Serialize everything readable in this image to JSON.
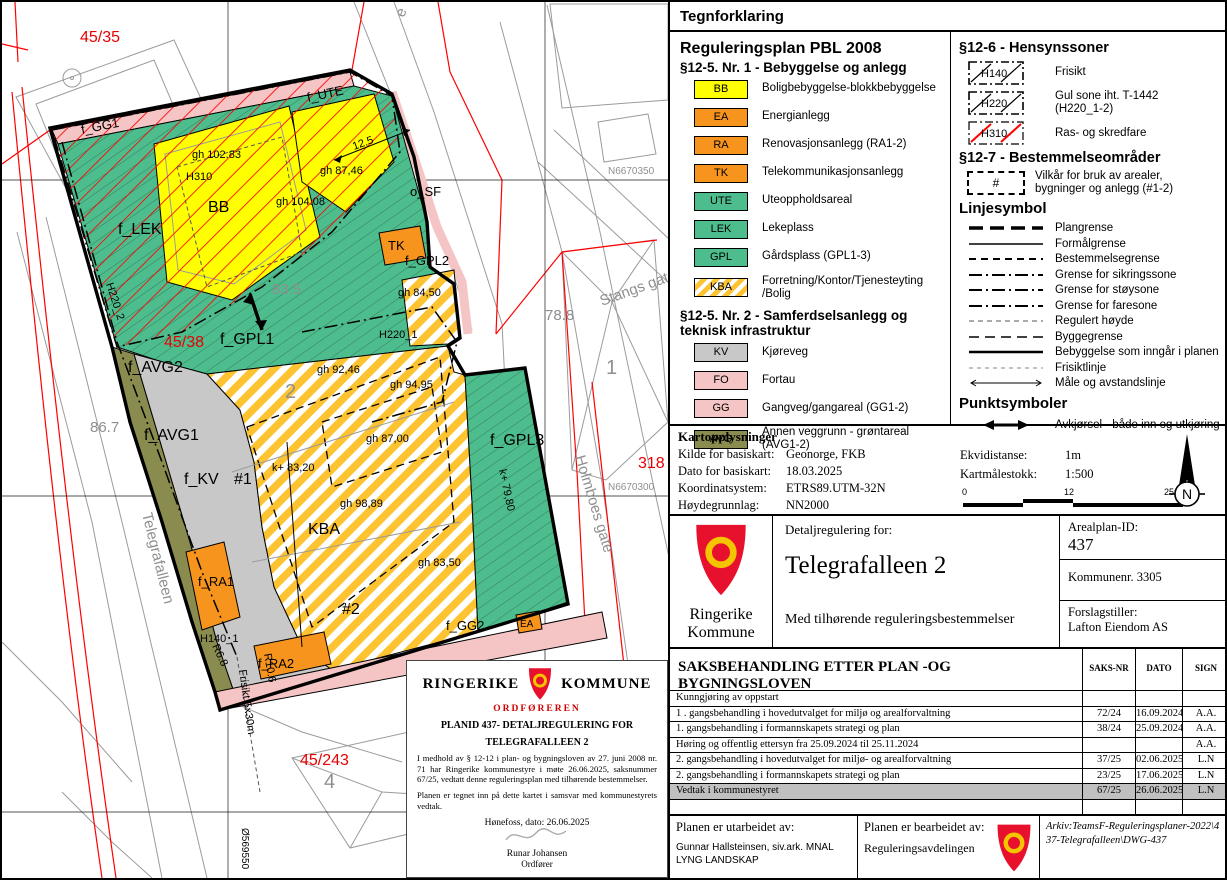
{
  "legend": {
    "title": "Tegnforklaring",
    "plan_heading": "Reguleringsplan PBL 2008",
    "s125_nr1_heading": "§12-5. Nr. 1 - Bebyggelse og anlegg",
    "s125_nr1_items": [
      {
        "code": "BB",
        "label": "Boligbebyggelse-blokkbebyggelse"
      },
      {
        "code": "EA",
        "label": "Energianlegg"
      },
      {
        "code": "RA",
        "label": "Renovasjonsanlegg (RA1-2)"
      },
      {
        "code": "TK",
        "label": "Telekommunikasjonsanlegg"
      },
      {
        "code": "UTE",
        "label": "Uteoppholdsareal"
      },
      {
        "code": "LEK",
        "label": "Lekeplass"
      },
      {
        "code": "GPL",
        "label": "Gårdsplass (GPL1-3)"
      },
      {
        "code": "KBA",
        "label": "Forretning/Kontor/Tjenesteyting /Bolig"
      }
    ],
    "s125_nr2_heading": "§12-5. Nr. 2 - Samferdselsanlegg og teknisk infrastruktur",
    "s125_nr2_items": [
      {
        "code": "KV",
        "label": "Kjøreveg"
      },
      {
        "code": "FO",
        "label": "Fortau"
      },
      {
        "code": "GG",
        "label": "Gangveg/gangareal (GG1-2)"
      },
      {
        "code": "AVG",
        "label": "Annen veggrunn - grøntareal (AVG1-2)"
      }
    ],
    "s126_heading": "§12-6 - Hensynssoner",
    "s126_items": [
      {
        "code": "H140",
        "label": "Frisikt"
      },
      {
        "code": "H220",
        "label": "Gul sone iht. T-1442 (H220_1-2)"
      },
      {
        "code": "H310",
        "label": "Ras- og skredfare"
      }
    ],
    "s127_heading": "§12-7 - Bestemmelseområder",
    "s127_code": "#",
    "s127_label": "Vilkår for bruk av arealer, bygninger og anlegg (#1-2)",
    "linjesymbol_heading": "Linjesymbol",
    "line_items": [
      {
        "label": "Plangrense",
        "style": "ls-plangrense"
      },
      {
        "label": "Formålgrense",
        "style": "ls-formal"
      },
      {
        "label": "Bestemmelsegrense",
        "style": "ls-bestemmelse"
      },
      {
        "label": "Grense for sikringssone",
        "style": "ls-sikring"
      },
      {
        "label": "Grense for støysone",
        "style": "ls-stoy"
      },
      {
        "label": "Grense for faresone",
        "style": "ls-fare"
      },
      {
        "label": "Regulert høyde",
        "style": "ls-hoyde"
      },
      {
        "label": "Byggegrense",
        "style": "ls-bygg"
      },
      {
        "label": "Bebyggelse som inngår i planen",
        "style": "ls-bebyggelse"
      },
      {
        "label": "Frisiktlinje",
        "style": "ls-frisikt"
      },
      {
        "label": "Måle og avstandslinje",
        "style": "ls-male"
      }
    ],
    "punktsymboler_heading": "Punktsymboler",
    "point_item_label": "Avkjørsel - både inn og utkjøring"
  },
  "map_info": {
    "heading": "Kartopplysninger",
    "rows": [
      {
        "label": "Kilde for basiskart:",
        "value": "Geonorge, FKB"
      },
      {
        "label": "Dato for basiskart:",
        "value": "18.03.2025"
      },
      {
        "label": "Koordinatsystem:",
        "value": "ETRS89.UTM-32N"
      },
      {
        "label": "Høydegrunnlag:",
        "value": "NN2000"
      }
    ],
    "rows_right": [
      {
        "label": "Ekvidistanse:",
        "value": "1m"
      },
      {
        "label": "Kartmålestokk:",
        "value": "1:500"
      }
    ],
    "scale_ticks": [
      "0",
      "12",
      "25m"
    ],
    "north_letter": "N"
  },
  "title_block": {
    "municipality_line1": "Ringerike",
    "municipality_line2": "Kommune",
    "detail_label": "Detaljregulering for:",
    "plan_name": "Telegrafalleen 2",
    "subtitle": "Med tilhørende reguleringsbestemmelser",
    "arealplan_label": "Arealplan-ID:",
    "arealplan_id": "437",
    "kommunenr": "Kommunenr. 3305",
    "forslagstiller_label": "Forslagstiller:",
    "forslagstiller": "Lafton Eiendom AS"
  },
  "case_table": {
    "title": "SAKSBEHANDLING ETTER PLAN -OG BYGNINGSLOVEN",
    "col_nr": "SAKS-NR",
    "col_dato": "DATO",
    "col_sign": "SIGN",
    "rows": [
      {
        "desc": "Kunngjøring av oppstart",
        "nr": "",
        "date": "",
        "sign": "",
        "hl": false
      },
      {
        "desc": "1 . gangsbehandling i hovedutvalget for miljø og arealforvaltning",
        "nr": "72/24",
        "date": "16.09.2024",
        "sign": "A.A.",
        "hl": false
      },
      {
        "desc": "1. gangsbehandling i formannskapets strategi og plan",
        "nr": "38/24",
        "date": "25.09.2024",
        "sign": "A.A.",
        "hl": false
      },
      {
        "desc": "Høring og offentlig ettersyn  fra 25.09.2024 til 25.11.2024",
        "nr": "",
        "date": "",
        "sign": "A.A.",
        "hl": false
      },
      {
        "desc": "2. gangsbehandling i hovedutvalget for miljø- og arealforvaltning",
        "nr": "37/25",
        "date": "02.06.2025",
        "sign": "L.N",
        "hl": false
      },
      {
        "desc": "2. gangsbehandling i formannskapets strategi og plan",
        "nr": "23/25",
        "date": "17.06.2025",
        "sign": "L.N",
        "hl": false
      },
      {
        "desc": "Vedtak i kommunestyret",
        "nr": "67/25",
        "date": "26.06.2025",
        "sign": "L.N",
        "hl": true
      },
      {
        "desc": "",
        "nr": "",
        "date": "",
        "sign": "",
        "hl": false
      }
    ]
  },
  "footer": {
    "prepared_label": "Planen er utarbeidet av:",
    "prepared_by1": "Gunnar Hallsteinsen, siv.ark. MNAL",
    "prepared_by2": "LYNG LANDSKAP",
    "processed_label": "Planen er bearbeidet av:",
    "processed_by": "Reguleringsavdelingen",
    "archive": "Arkiv:TeamsF-Reguleringsplaner-2022\\437-Telegrafalleen\\DWG-437"
  },
  "stamp": {
    "name_left": "RINGERIKE",
    "name_right": "KOMMUNE",
    "role": "ORDFØREREN",
    "title1": "PLANID 437- DETALJREGULERING FOR",
    "title2": "TELEGRAFALLEEN 2",
    "para1": "I medhold av § 12-12 i plan- og bygningsloven av 27. juni 2008 nr. 71 har Ringerike kommunestyre i møte 26.06.2025, saksnummer 67/25, vedtatt denne reguleringsplan med tilhørende bestemmelser.",
    "para2": "Planen er tegnet inn på dette kartet i samsvar med kommunestyrets vedtak.",
    "place_date": "Hønefoss, dato: 26.06.2025",
    "signer": "Runar Johansen",
    "signer_role": "Ordfører"
  },
  "map_labels": {
    "parcel_45_35": "45/35",
    "parcel_45_38": "45/38",
    "parcel_45_243": "45/243",
    "parcel_318": "318",
    "house_4": "4",
    "house_1": "1",
    "elev_78_8": "78.8",
    "elev_86_7": "86.7",
    "elev_83_5": "83.5",
    "big_2": "2",
    "street_telegrafalleen": "Telegrafalleen",
    "street_holmboes": "Holmboes gate",
    "street_stangs": "Stangs gate",
    "street_e": "e",
    "grid_n1": "N6670350",
    "grid_n2": "N6670300",
    "grid_e1": "Ø569550",
    "zone_f_gg1": "f_GG1",
    "zone_f_ute": "f_UTE",
    "zone_f_lek": "f_LEK",
    "zone_bb": "BB",
    "zone_tk": "TK",
    "zone_f_gpl2": "f_GPL2",
    "zone_f_gpl1": "f_GPL1",
    "zone_f_avg2": "f_AVG2",
    "zone_f_avg1": "f_AVG1",
    "zone_f_kv": "f_KV",
    "zone_hash1": "#1",
    "zone_kba": "KBA",
    "zone_hash2": "#2",
    "zone_f_ra1": "f_RA1",
    "zone_f_ra2": "f_RA2",
    "zone_f_gg2": "f_GG2",
    "zone_ea": "EA",
    "zone_f_gpl3": "f_GPL3",
    "zone_o_sf": "o_SF",
    "h310": "H310",
    "h220_1": "H220_1",
    "h220_2": "H220_2",
    "h140_1": "H140_1",
    "gh_102_83": "gh 102.83",
    "gh_104_08": "gh 104.08",
    "gh_87_46": "gh 87,46",
    "gh_84_50": "gh 84,50",
    "gh_92_46": "gh 92,46",
    "gh_94_95": "gh 94,95",
    "gh_87_00": "gh 87,00",
    "gh_98_89": "gh 98,89",
    "gh_83_50": "gh 83,50",
    "k_83_20": "k+ 83,20",
    "k_79_80": "k+ 79,80",
    "dim_12_5": "12.5",
    "r10_6": "R10.6",
    "r6_8": "R6.8",
    "frisikt_dim": "Frisikt 5x30m"
  },
  "colors": {
    "shield_red": "#e8112d",
    "shield_yellow": "#f5c400",
    "zone_yellow": "#ffff00",
    "zone_orange": "#f7941e",
    "zone_green": "#4ebd8d",
    "zone_gray": "#c8c8c8",
    "zone_pink": "#f5c5c5",
    "zone_olive": "#8a8b4f",
    "kba_stripe": "#fdc330",
    "hatch_red": "#ff0000",
    "highlight_gray": "#c0c0c0"
  }
}
